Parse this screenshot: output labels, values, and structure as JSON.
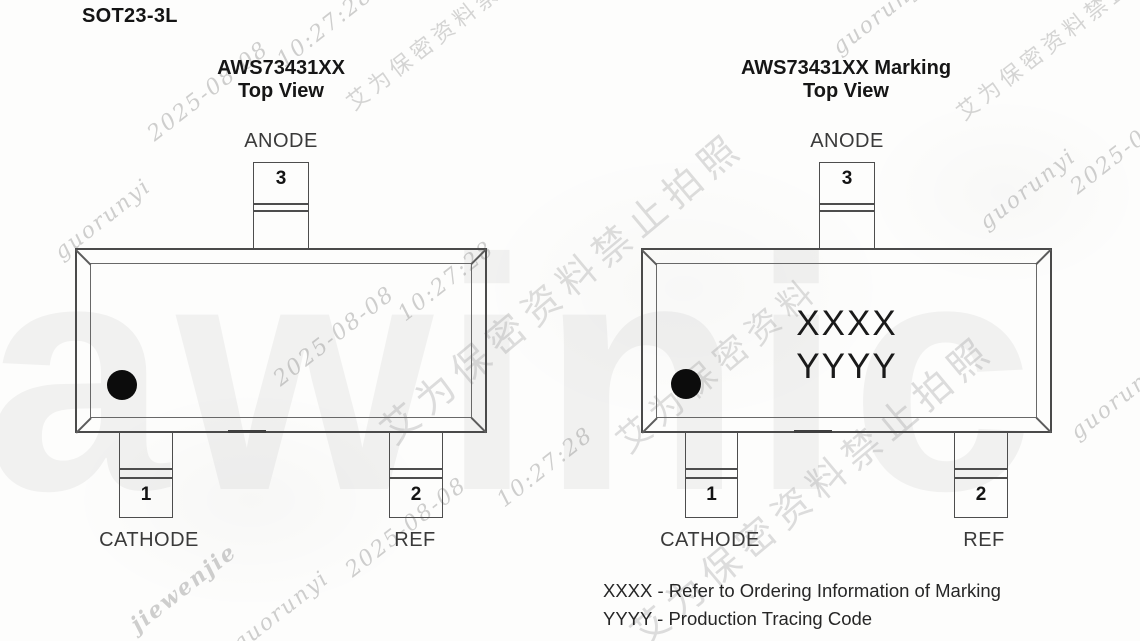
{
  "title": "SOT23-3L",
  "left_diagram": {
    "heading": "AWS73431XX",
    "subheading": "Top View",
    "pin3": {
      "number": "3",
      "label": "ANODE"
    },
    "pin1": {
      "number": "1",
      "label": "CATHODE"
    },
    "pin2": {
      "number": "2",
      "label": "REF"
    }
  },
  "right_diagram": {
    "heading": "AWS73431XX Marking",
    "subheading": "Top View",
    "marking_line1": "XXXX",
    "marking_line2": "YYYY",
    "pin3": {
      "number": "3",
      "label": "ANODE"
    },
    "pin1": {
      "number": "1",
      "label": "CATHODE"
    },
    "pin2": {
      "number": "2",
      "label": "REF"
    }
  },
  "notes": {
    "line1": "XXXX - Refer to Ordering Information of Marking",
    "line2": "YYYY - Production Tracing Code"
  },
  "watermarks": {
    "username": "guorunyi",
    "username2": "jiewenjie",
    "date": "2025-08-08",
    "time": "10:27:28",
    "confidential": "艾为保密资料禁止拍照",
    "confidential_fragment": "艾为保密资料",
    "logo": "awinic"
  },
  "colors": {
    "line": "#4a4a4a",
    "text": "#161616",
    "pin_label": "#3a3a3a",
    "pin1_dot": "#0c0c0c",
    "watermark": "#8c8c8c",
    "background": "#fdfdfc"
  }
}
